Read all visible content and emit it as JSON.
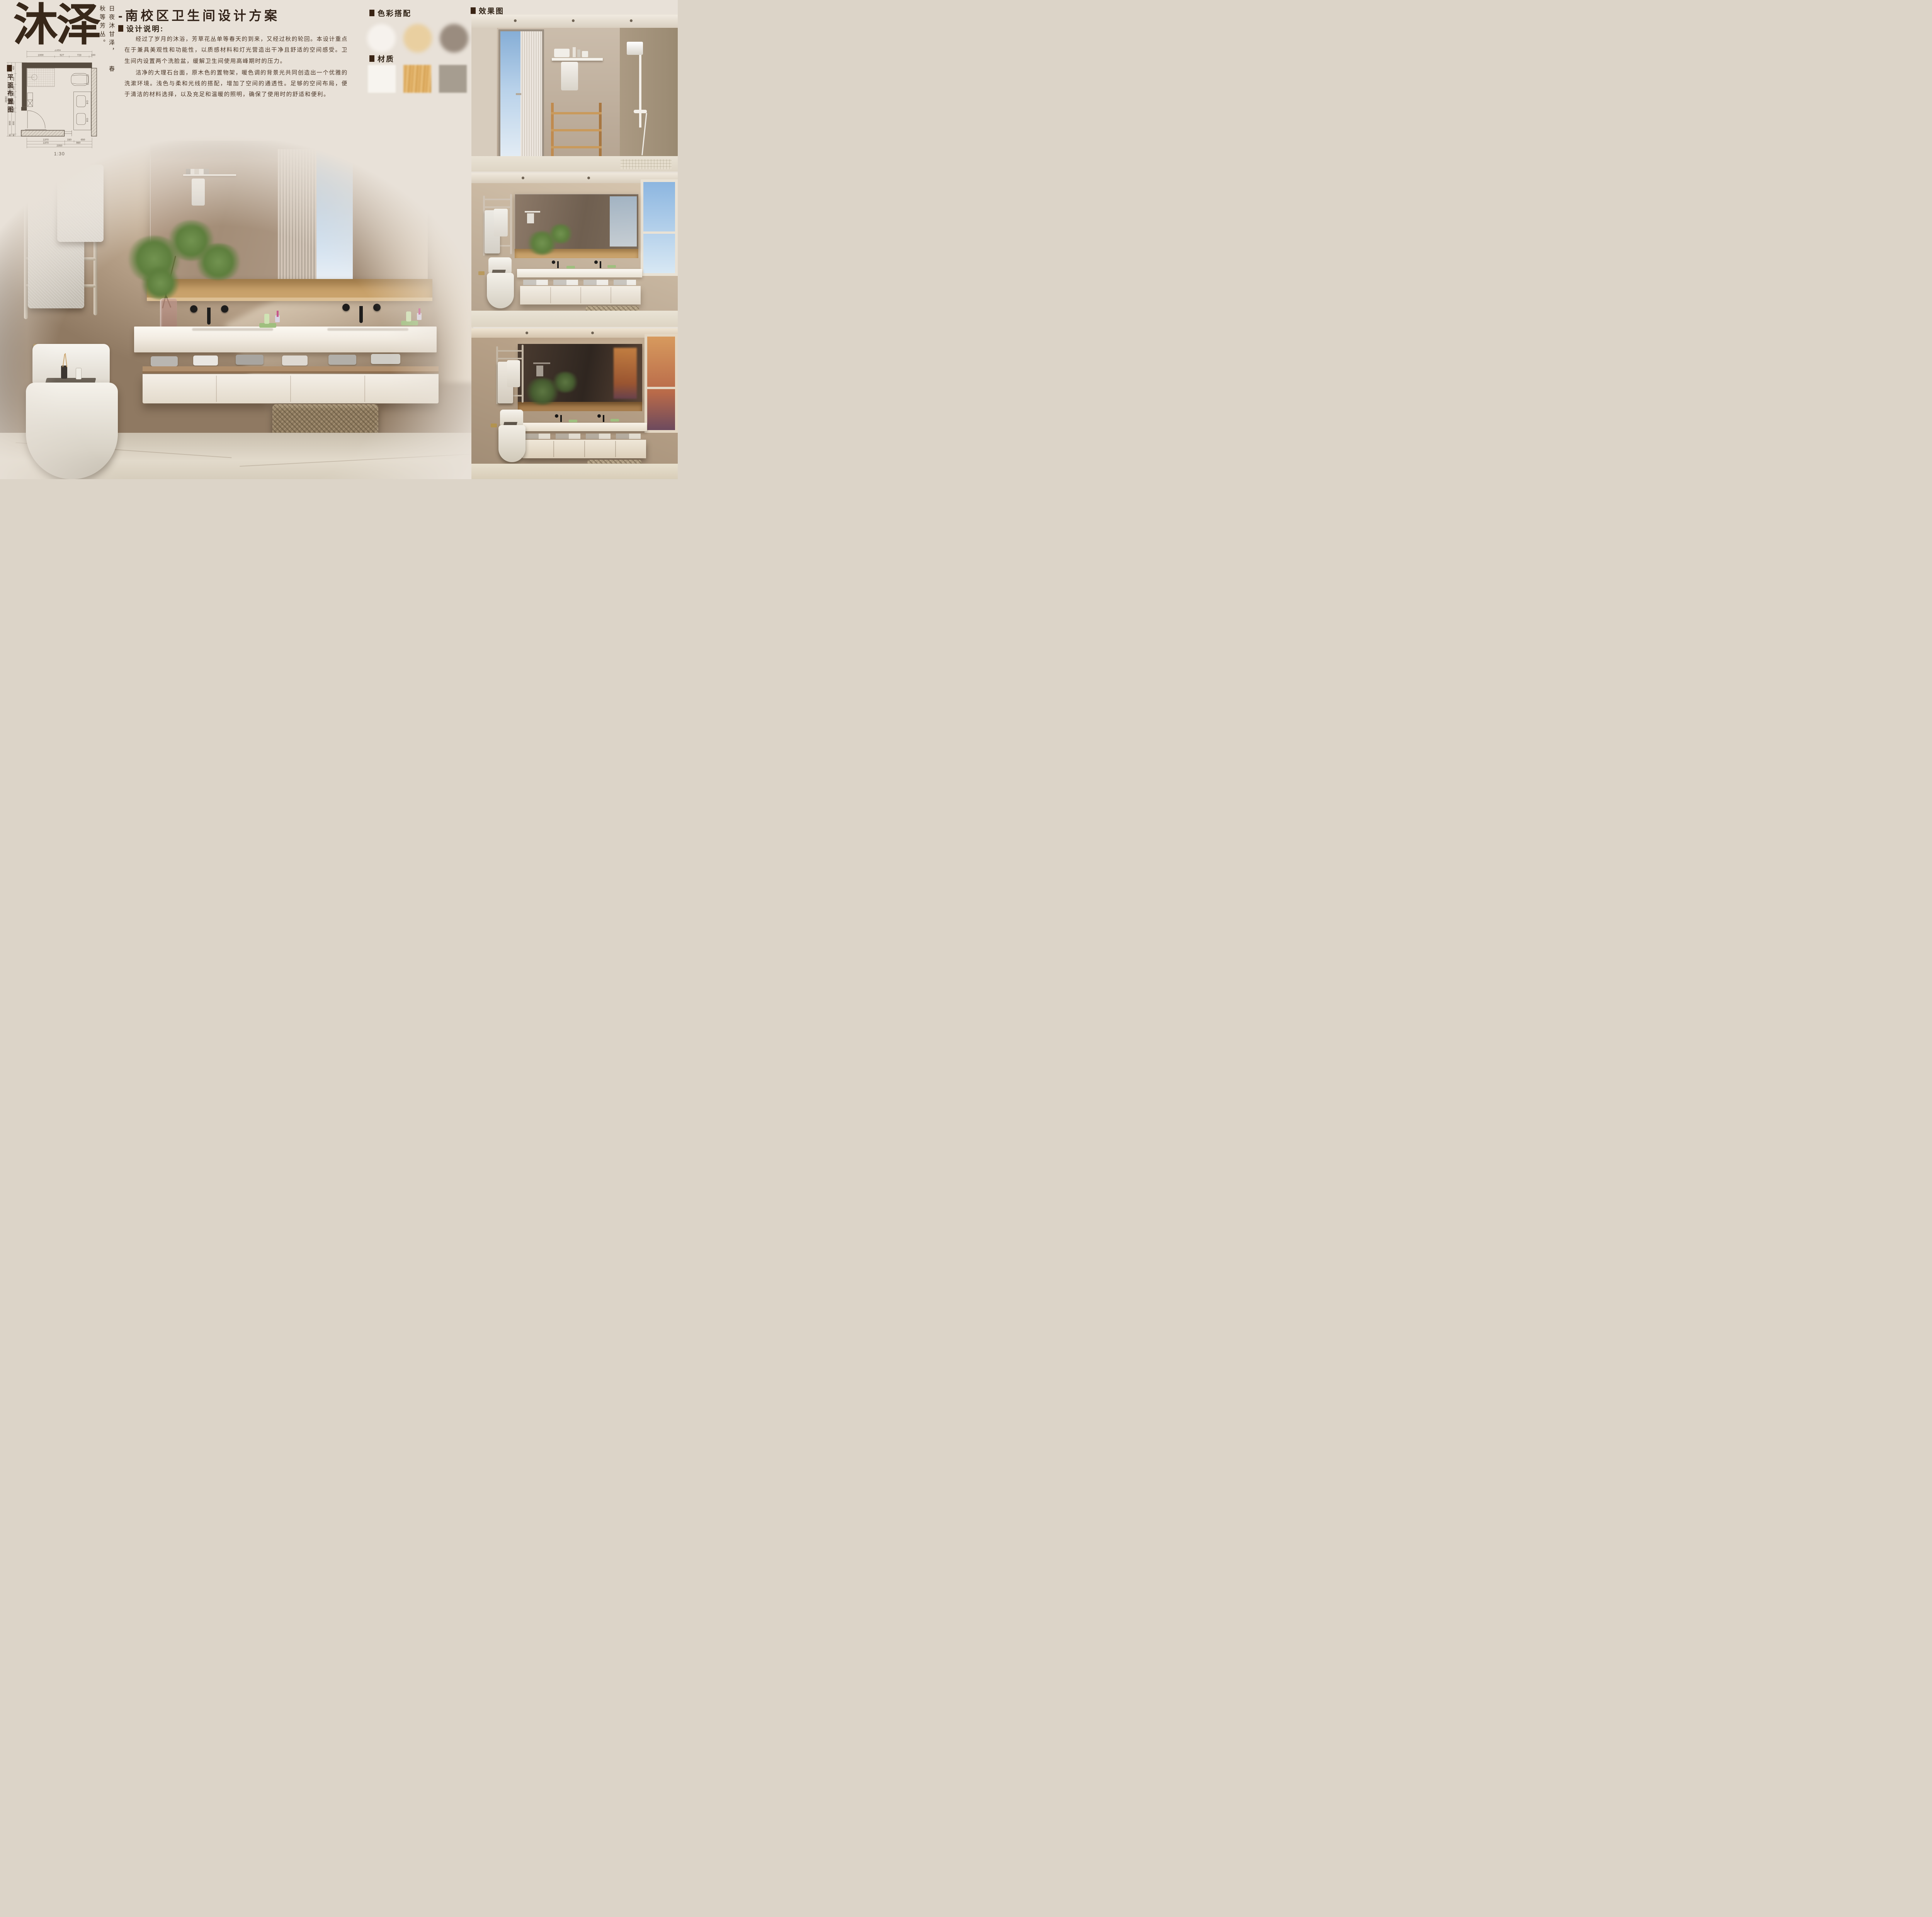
{
  "ui": {
    "bullet": "■"
  },
  "logo": {
    "name": "沐泽",
    "tagline_right": "日夜沐甘泽，",
    "tagline_left": "春秋等芳丛。"
  },
  "title": "-南校区卫生间设计方案",
  "design_notes": {
    "heading": "设计说明:",
    "paragraphs": [
      "经过了岁月的沐浴，芳草花丛单等春天的到来，又经过秋的轮回。本设计重点在于兼具美观性和功能性，以质感材料和灯光营造出干净且舒适的空间感受。卫生间内设置两个洗脸盆，缓解卫生间使用高峰期时的压力。",
      "洁净的大理石台面，原木色的置物架，暖色调的背景光共同创造出一个优雅的洗漱环境。浅色与柔和光线的搭配，增加了空间的通透性。足够的空间布局，便于清洁的材料选择，以及充足和温暖的照明，确保了使用时的舒适和便利。"
    ]
  },
  "palette": {
    "heading": "色彩搭配",
    "swatches": [
      {
        "name": "warm-white",
        "color": "#f6f2ed"
      },
      {
        "name": "sand-beige",
        "color": "#e9cfa0"
      },
      {
        "name": "taupe-grey",
        "color": "#9a8c7f"
      }
    ]
  },
  "materials": {
    "heading": "材质",
    "swatches": [
      {
        "name": "white-stone",
        "color": "#f7f4ef"
      },
      {
        "name": "light-wood",
        "color": "#dfae63"
      },
      {
        "name": "grey-stone",
        "color": "#a69d90"
      }
    ]
  },
  "renders": {
    "heading": "效果图"
  },
  "floor_plan": {
    "label": "平面布置图",
    "scale": "1:30",
    "top_total": "2350",
    "top_segs": [
      "1000",
      "527",
      "723",
      "100"
    ],
    "left_total": "2690",
    "left_mid": [
      "1810",
      "800",
      "80"
    ],
    "left_inner": [
      "400",
      "400",
      "260",
      "200",
      "400",
      "150",
      "800",
      "80"
    ],
    "bottom_r1": [
      "1370",
      "330",
      "650"
    ],
    "bottom_r2": [
      "1370",
      "980"
    ],
    "bottom_total": "2350"
  },
  "colors": {
    "page_bg": "#e8e1d8",
    "ink": "#38281a",
    "photo_wall": "#b09a82",
    "wood_shelf": "#c9a26b"
  }
}
